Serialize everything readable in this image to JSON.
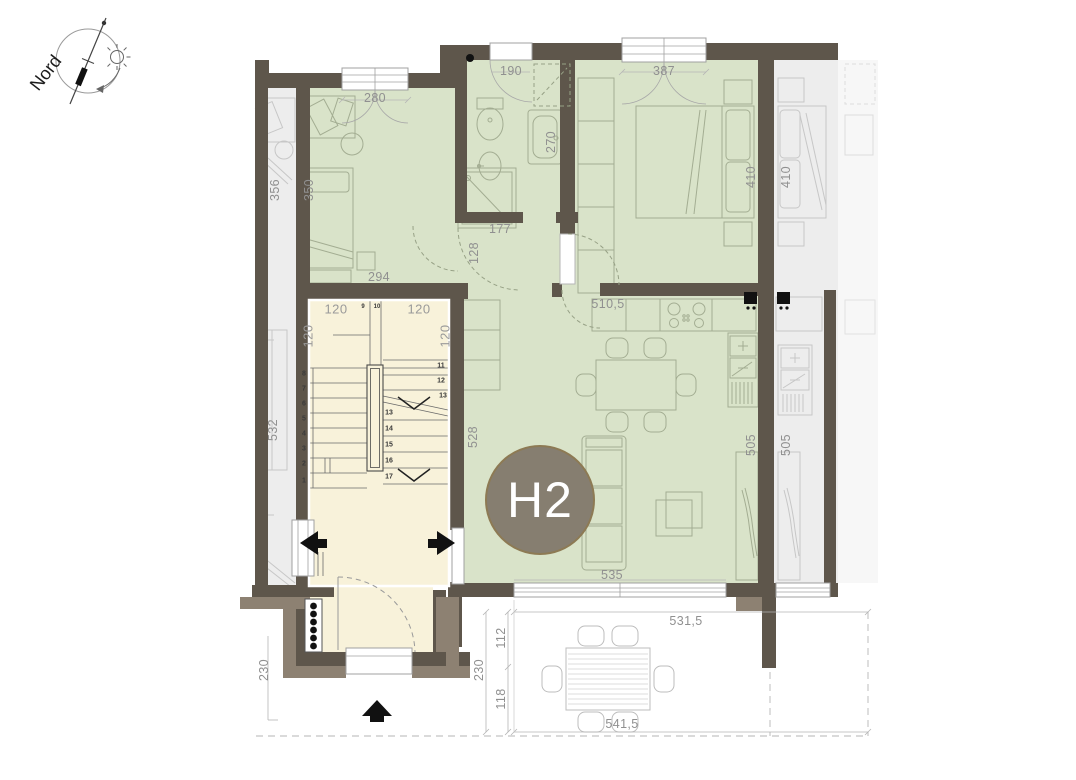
{
  "plan": {
    "unit_label": "H2",
    "compass_label": "Nord"
  },
  "dimensions": {
    "bedroom2_window": "280",
    "bathroom_top": "190",
    "bedroom1_window": "387",
    "neighbor_left_room_depth": "356",
    "bedroom2_depth": "350",
    "bedroom1_depth": "410",
    "neighbor_right_room_depth": "410",
    "bathroom_right_wall": "270",
    "bathroom_width": "177",
    "hall_width": "128",
    "bedroom2_width": "294",
    "living_kitchen_width": "510,5",
    "stair_flight_top_left": "120",
    "stair_flight_top_right": "120",
    "stair_side_left": "120",
    "stair_side_right": "120",
    "neighbor_left_lower_depth": "532",
    "living_left_depth": "528",
    "living_sideboard_wall": "505",
    "neighbor_sideboard_wall": "505",
    "living_window": "535",
    "terrace_width_top": "531,5",
    "terrace_depth_upper": "112",
    "terrace_depth_total": "230",
    "terrace_depth_lower": "118",
    "terrace_width_bottom": "541,5",
    "entrance_recess_depth": "230"
  },
  "stairs": {
    "steps_left": [
      "1",
      "2",
      "3",
      "4",
      "5",
      "6",
      "7",
      "8"
    ],
    "steps_top": [
      "9",
      "10"
    ],
    "steps_right": [
      "11",
      "12",
      "13"
    ],
    "steps_middle": [
      "13",
      "14",
      "15",
      "16",
      "17"
    ]
  },
  "colors": {
    "apartment_fill": "#d9e3c9",
    "stairwell_fill": "#f8f2da",
    "neighbor_fill": "#ededed",
    "wall": "#5e564b",
    "wall_light": "#8d8172",
    "unit_badge": "#867e70",
    "dimension_text": "#909090"
  }
}
